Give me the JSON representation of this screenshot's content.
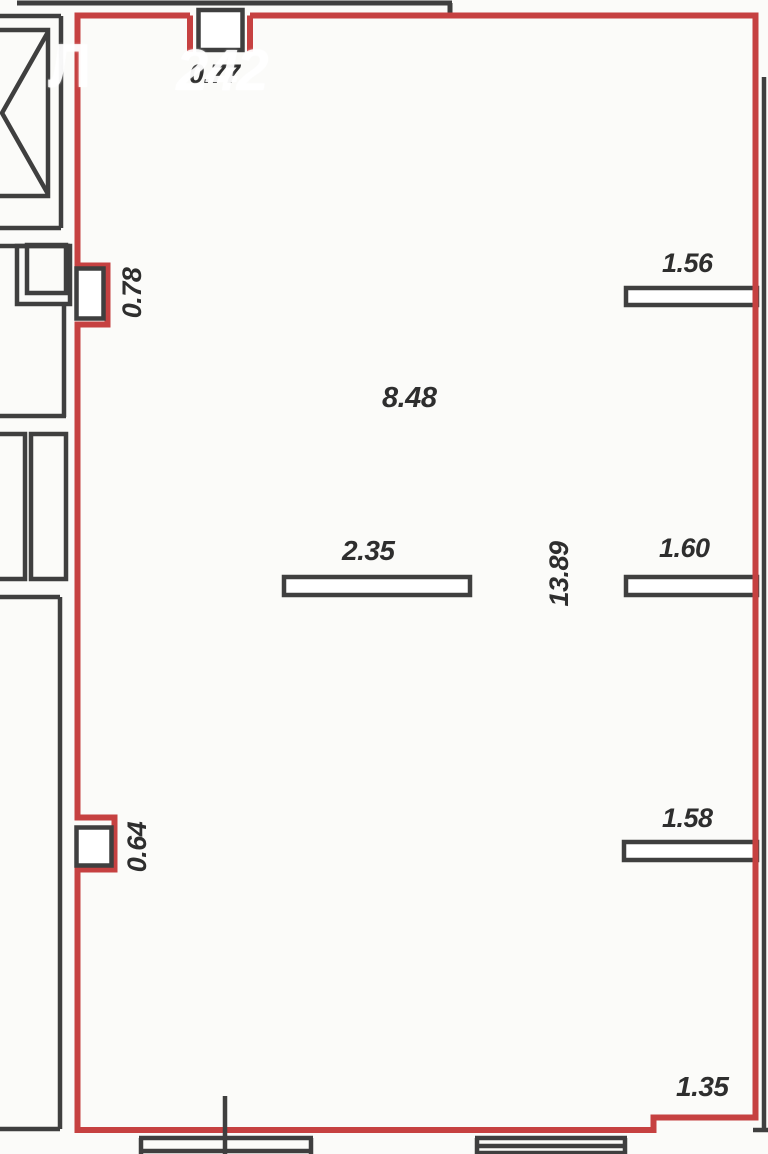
{
  "plan": {
    "dims": {
      "top_opening": "0.77",
      "niche_upper": "0.78",
      "room_width": "8.48",
      "partition_mid": "2.35",
      "room_length": "13.89",
      "stub_upper": "1.56",
      "stub_middle": "1.60",
      "stub_lower": "1.58",
      "niche_lower": "0.64",
      "step_bottom": "1.35"
    },
    "watermark": {
      "letter": "Л",
      "digits": "242"
    },
    "colors": {
      "wall_red": "#c64141",
      "line_gray": "#3f3f3f",
      "dim_text": "#2e2e2e",
      "background": "#fbfbf9",
      "watermark": "#ffffff"
    }
  }
}
